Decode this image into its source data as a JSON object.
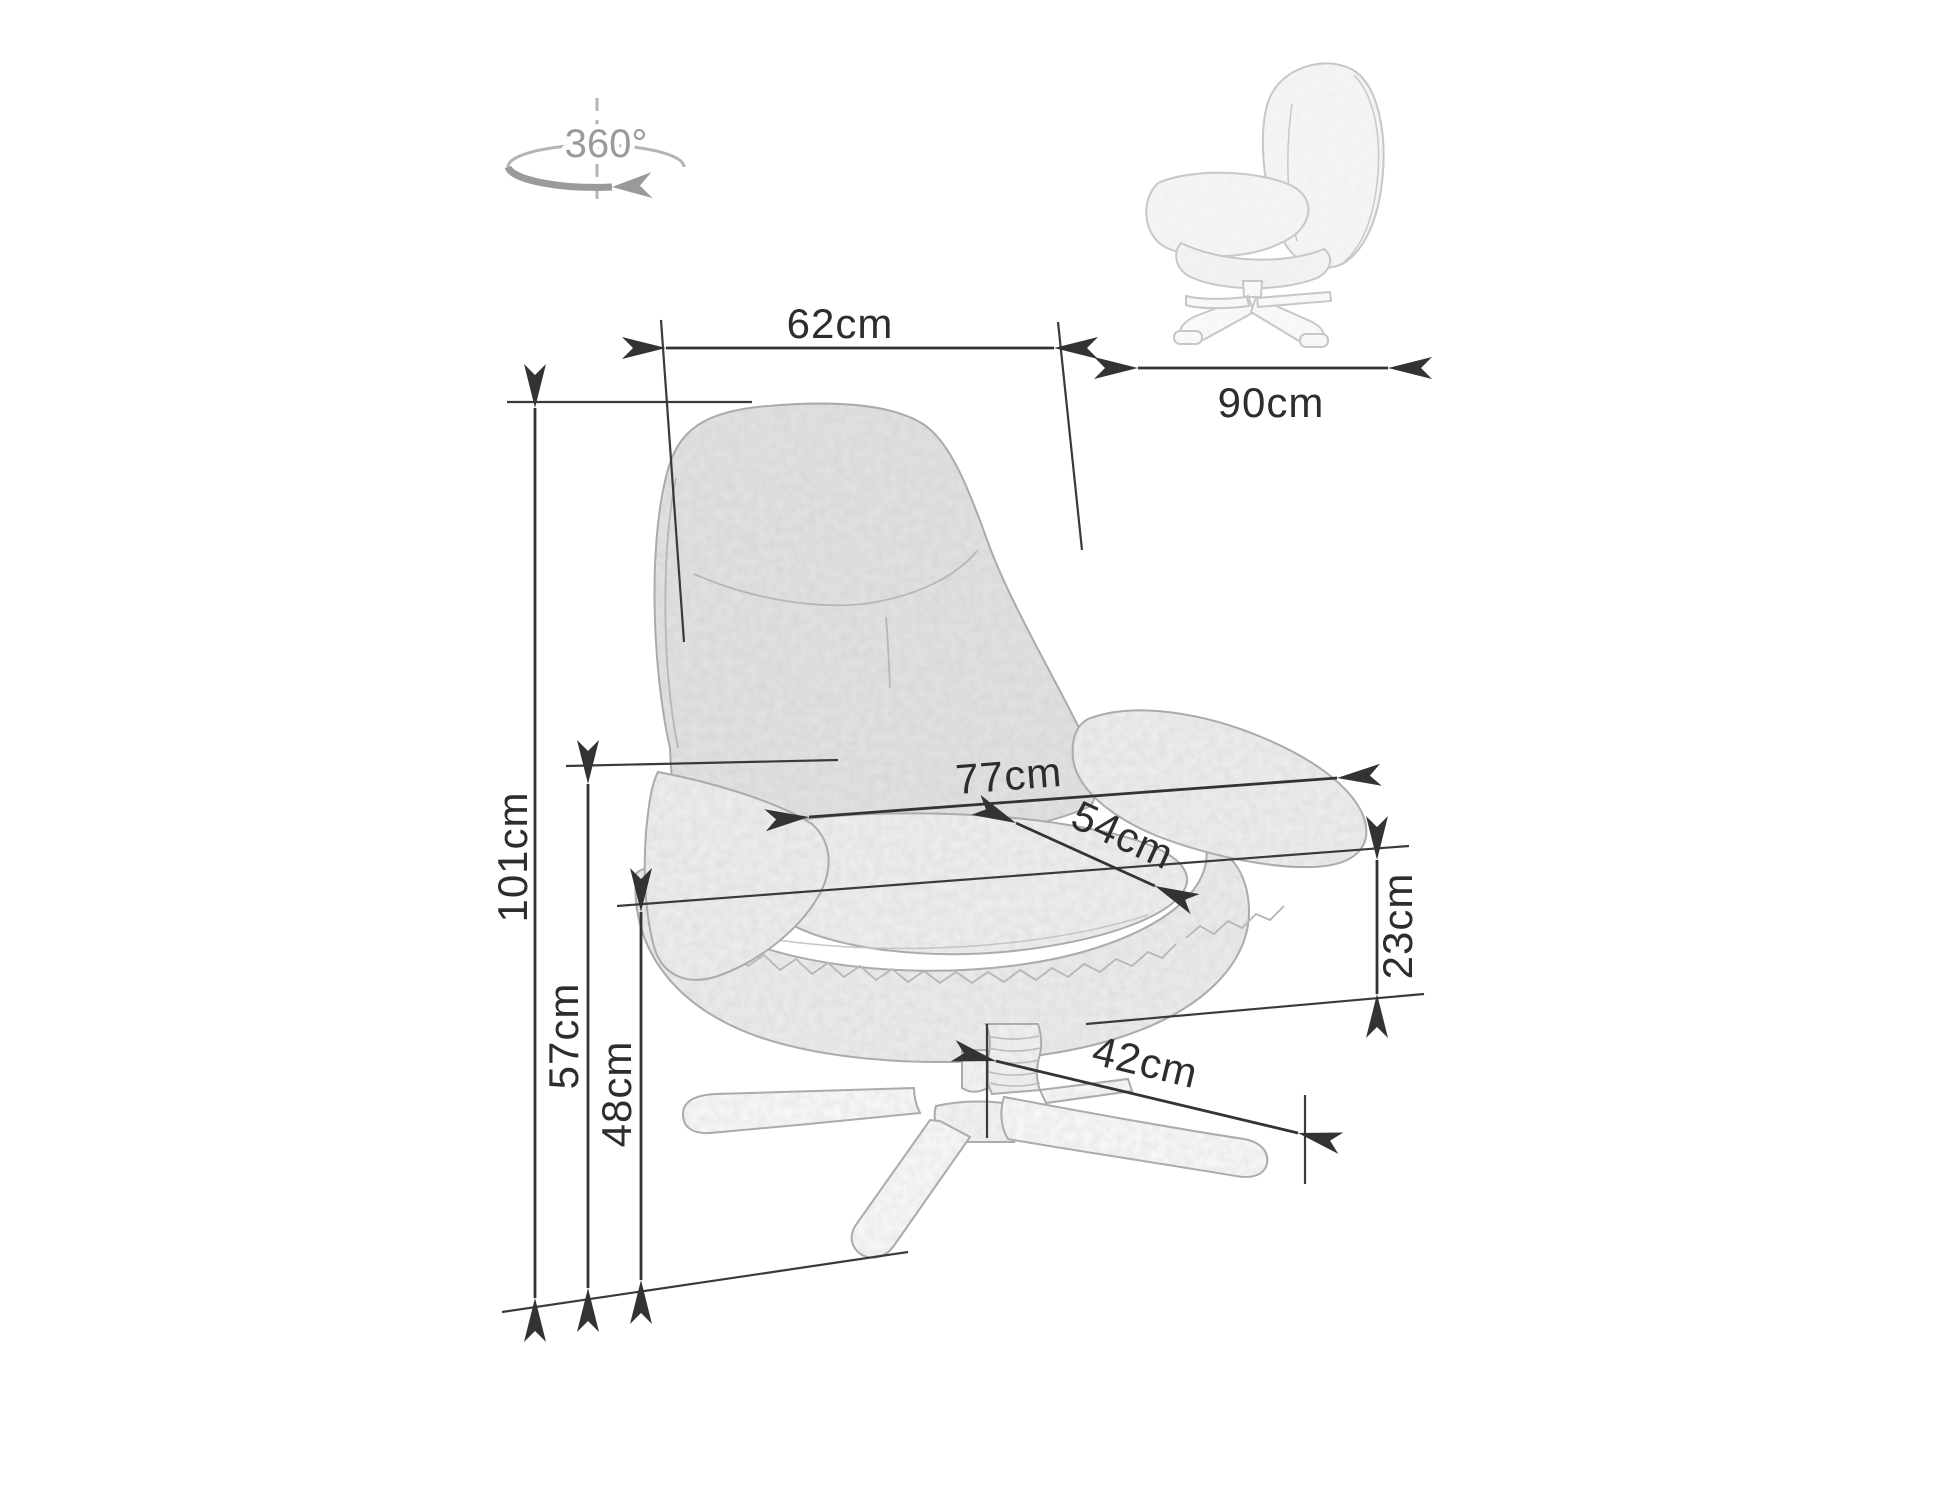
{
  "diagram": {
    "type": "product-dimension-diagram",
    "product": "swivel upholstered armchair with star base",
    "background_color": "#ffffff",
    "dimension_line_color": "#333333",
    "label_color": "#2d2d2d",
    "sketch_color": "#ababab",
    "rotation": {
      "label": "360°",
      "color": "#9a9a9a",
      "icon": "rotation-swivel-arrow-icon"
    },
    "views": [
      {
        "id": "front-view",
        "description": "armchair front view with swivel base"
      },
      {
        "id": "side-view",
        "description": "armchair side view (small, top right)"
      }
    ],
    "dimensions": [
      {
        "id": "backrest-width",
        "label": "62cm",
        "value": 62,
        "unit": "cm",
        "orientation": "horizontal"
      },
      {
        "id": "depth",
        "label": "90cm",
        "value": 90,
        "unit": "cm",
        "orientation": "horizontal"
      },
      {
        "id": "total-height",
        "label": "101cm",
        "value": 101,
        "unit": "cm",
        "orientation": "vertical"
      },
      {
        "id": "armrest-height",
        "label": "57cm",
        "value": 57,
        "unit": "cm",
        "orientation": "vertical"
      },
      {
        "id": "seat-height",
        "label": "48cm",
        "value": 48,
        "unit": "cm",
        "orientation": "vertical"
      },
      {
        "id": "total-width",
        "label": "77cm",
        "value": 77,
        "unit": "cm",
        "orientation": "horizontal"
      },
      {
        "id": "seat-width",
        "label": "54cm",
        "value": 54,
        "unit": "cm",
        "orientation": "diagonal"
      },
      {
        "id": "cushion-thickness",
        "label": "23cm",
        "value": 23,
        "unit": "cm",
        "orientation": "vertical"
      },
      {
        "id": "base-leg-reach",
        "label": "42cm",
        "value": 42,
        "unit": "cm",
        "orientation": "diagonal"
      }
    ]
  }
}
